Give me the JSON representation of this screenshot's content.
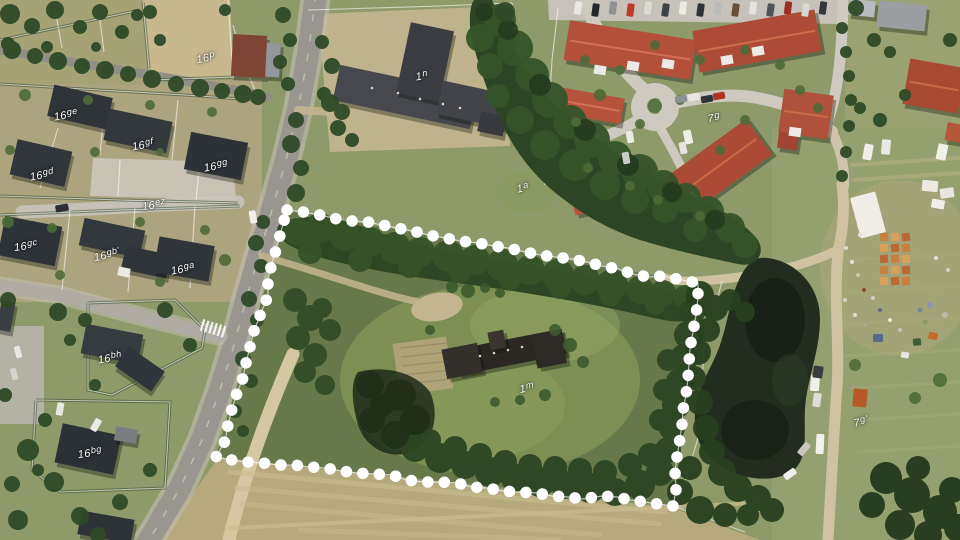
{
  "map": {
    "kind": "aerial-photo-with-cadastral-overlay",
    "colors": {
      "boundary_dots": "#ffffff",
      "parcel_lines": "#ffffff",
      "label_text": "#ffffff"
    },
    "parcel_labels": [
      {
        "id": "16p",
        "text": "16p",
        "num": "16",
        "suffix": "p",
        "x": 206,
        "y": 59,
        "rot": -12
      },
      {
        "id": "16ge",
        "text": "16ge",
        "num": "16",
        "suffix": "ge",
        "x": 66,
        "y": 116,
        "rot": -10
      },
      {
        "id": "16gf",
        "text": "16gf",
        "num": "16",
        "suffix": "gf",
        "x": 143,
        "y": 146,
        "rot": -10
      },
      {
        "id": "16gd",
        "text": "16gd",
        "num": "16",
        "suffix": "gd",
        "x": 42,
        "y": 176,
        "rot": -10
      },
      {
        "id": "16gg",
        "text": "16gg",
        "num": "16",
        "suffix": "gg",
        "x": 216,
        "y": 167,
        "rot": -10
      },
      {
        "id": "16ez",
        "text": "16ez",
        "num": "16",
        "suffix": "ez",
        "x": 154,
        "y": 206,
        "rot": -8
      },
      {
        "id": "16gc",
        "text": "16gc",
        "num": "16",
        "suffix": "gc",
        "x": 26,
        "y": 247,
        "rot": -8
      },
      {
        "id": "16gb",
        "text": "16gb'",
        "num": "16",
        "suffix": "gb'",
        "x": 107,
        "y": 256,
        "rot": -12
      },
      {
        "id": "16ga",
        "text": "16ga",
        "num": "16",
        "suffix": "ga",
        "x": 183,
        "y": 270,
        "rot": -10
      },
      {
        "id": "16bh",
        "text": "16bh",
        "num": "16",
        "suffix": "bh",
        "x": 110,
        "y": 359,
        "rot": -10
      },
      {
        "id": "16bg",
        "text": "16bg",
        "num": "16",
        "suffix": "bg",
        "x": 90,
        "y": 454,
        "rot": -8
      },
      {
        "id": "1n",
        "text": "1n",
        "num": "1",
        "suffix": "n",
        "x": 422,
        "y": 77,
        "rot": -10
      },
      {
        "id": "1a",
        "text": "1a",
        "num": "1",
        "suffix": "a",
        "x": 523,
        "y": 189,
        "rot": -12
      },
      {
        "id": "1m",
        "text": "1m",
        "num": "1",
        "suffix": "m",
        "x": 527,
        "y": 389,
        "rot": -12
      },
      {
        "id": "7g",
        "text": "7g",
        "num": "7",
        "suffix": "g",
        "x": 714,
        "y": 119,
        "rot": -10
      },
      {
        "id": "7g2",
        "text": "7g'",
        "num": "7",
        "suffix": "g'",
        "x": 861,
        "y": 423,
        "rot": -12
      }
    ],
    "highlight_boundary": {
      "color": "#ffffff",
      "dot_diameter": 11.5,
      "dot_spacing": 16.4,
      "points": [
        [
          287,
          210
        ],
        [
          303,
          212
        ],
        [
          320,
          215
        ],
        [
          337,
          219
        ],
        [
          352,
          221
        ],
        [
          368,
          222
        ],
        [
          382,
          225
        ],
        [
          397,
          228
        ],
        [
          413,
          231
        ],
        [
          428,
          235
        ],
        [
          445,
          238
        ],
        [
          460,
          241
        ],
        [
          478,
          243
        ],
        [
          493,
          246
        ],
        [
          508,
          248
        ],
        [
          525,
          252
        ],
        [
          540,
          255
        ],
        [
          555,
          257
        ],
        [
          572,
          259
        ],
        [
          587,
          262
        ],
        [
          602,
          266
        ],
        [
          618,
          269
        ],
        [
          633,
          274
        ],
        [
          648,
          277
        ],
        [
          663,
          276
        ],
        [
          682,
          280
        ],
        [
          698,
          283
        ],
        [
          698,
          298
        ],
        [
          696,
          315
        ],
        [
          693,
          332
        ],
        [
          690,
          348
        ],
        [
          689,
          363
        ],
        [
          688,
          378
        ],
        [
          686,
          395
        ],
        [
          683,
          410
        ],
        [
          682,
          425
        ],
        [
          680,
          438
        ],
        [
          677,
          457
        ],
        [
          675,
          472
        ],
        [
          676,
          490
        ],
        [
          673,
          506
        ],
        [
          658,
          504
        ],
        [
          645,
          502
        ],
        [
          630,
          500
        ],
        [
          617,
          497
        ],
        [
          602,
          496
        ],
        [
          583,
          499
        ],
        [
          568,
          497
        ],
        [
          552,
          496
        ],
        [
          537,
          493
        ],
        [
          518,
          492
        ],
        [
          503,
          491
        ],
        [
          487,
          488
        ],
        [
          472,
          487
        ],
        [
          457,
          483
        ],
        [
          440,
          482
        ],
        [
          423,
          482
        ],
        [
          407,
          480
        ],
        [
          392,
          475
        ],
        [
          375,
          474
        ],
        [
          356,
          473
        ],
        [
          342,
          471
        ],
        [
          325,
          468
        ],
        [
          310,
          467
        ],
        [
          294,
          465
        ],
        [
          278,
          465
        ],
        [
          263,
          463
        ],
        [
          247,
          462
        ],
        [
          232,
          460
        ],
        [
          216,
          457
        ],
        [
          225,
          441
        ],
        [
          228,
          425
        ],
        [
          232,
          409
        ],
        [
          237,
          393
        ],
        [
          243,
          378
        ],
        [
          246,
          363
        ],
        [
          251,
          343
        ],
        [
          254,
          331
        ],
        [
          261,
          313
        ],
        [
          268,
          296
        ],
        [
          268,
          280
        ],
        [
          272,
          263
        ],
        [
          277,
          247
        ],
        [
          282,
          228
        ],
        [
          287,
          210
        ]
      ]
    }
  }
}
